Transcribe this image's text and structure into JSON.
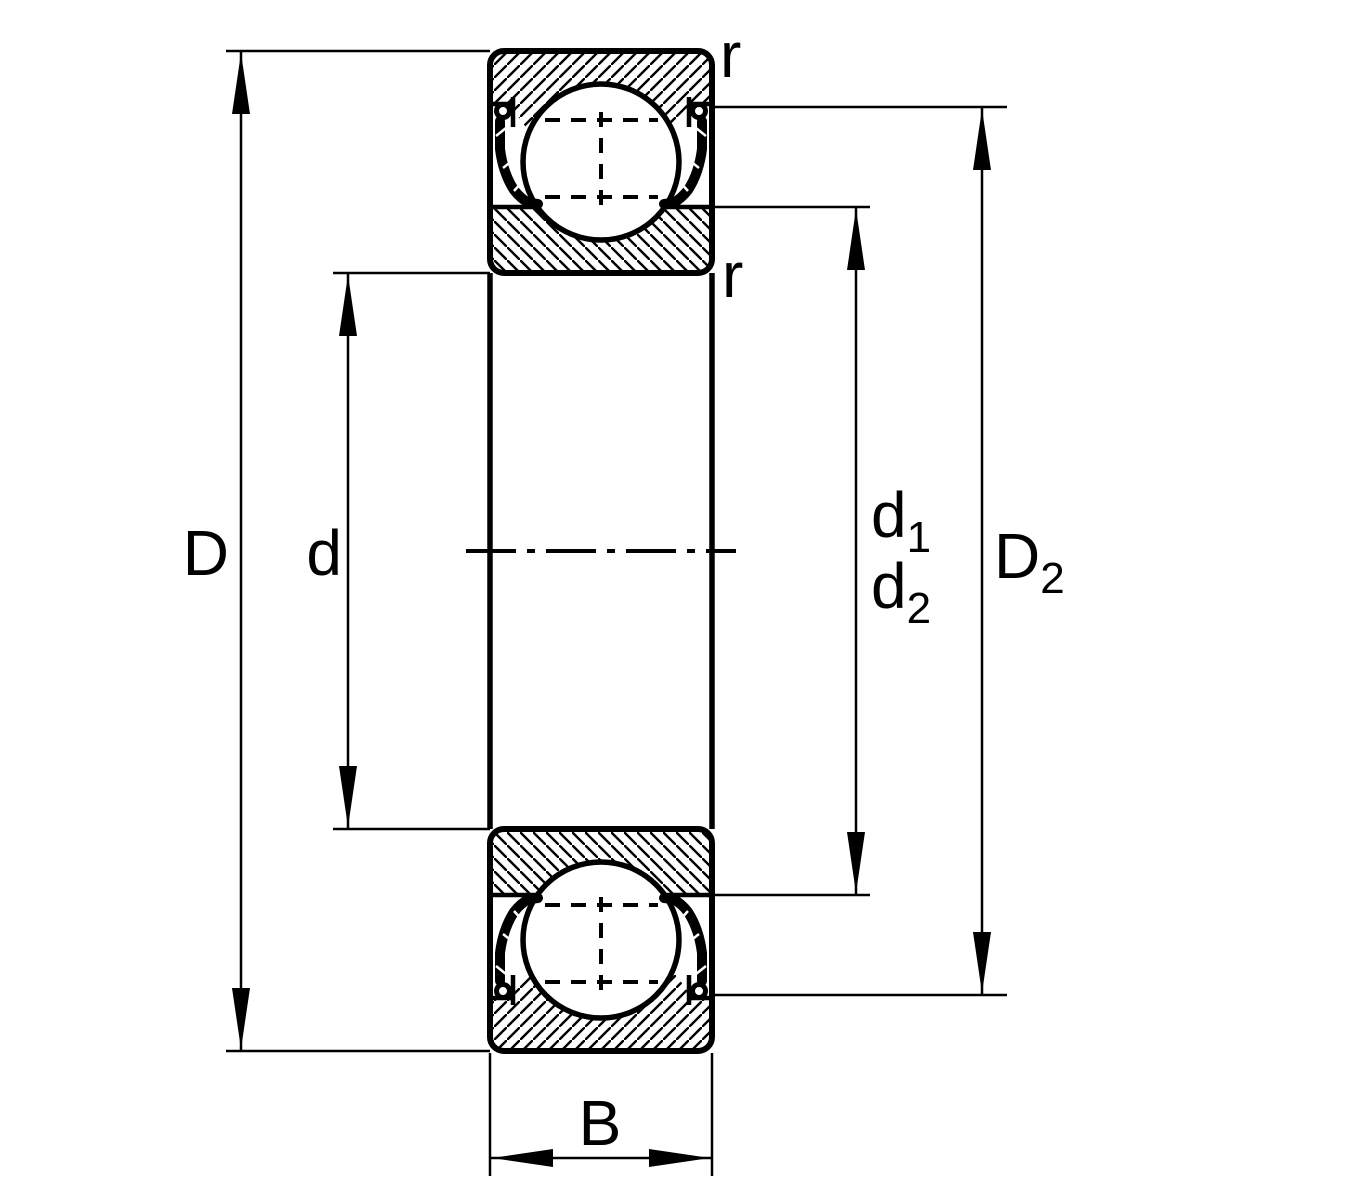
{
  "diagram": {
    "type": "deep-groove-ball-bearing-cross-section",
    "labels": {
      "outer_diameter": "D",
      "bore_diameter": "d",
      "d1": {
        "base": "d",
        "sub": "1"
      },
      "d2": {
        "base": "d",
        "sub": "2"
      },
      "D2": {
        "base": "D",
        "sub": "2"
      },
      "width": "B",
      "fillet_top": "r",
      "fillet_bottom": "r"
    },
    "colors": {
      "line": "#000000",
      "background": "#ffffff"
    }
  }
}
